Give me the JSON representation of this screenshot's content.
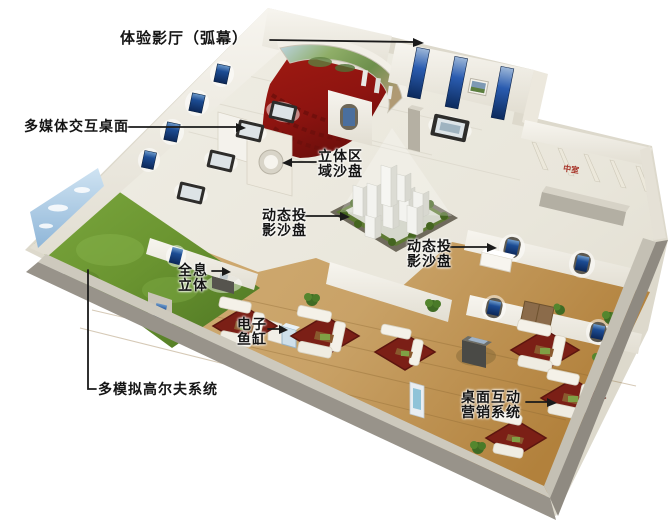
{
  "figure": {
    "type": "exhibition-hall-3d-floorplan",
    "background": "#ffffff"
  },
  "labels": {
    "experience_theater": {
      "text": "体验影厅（弧幕）"
    },
    "multimedia_desk": {
      "text": "多媒体交互桌面"
    },
    "stereo_sandbox": {
      "line1": "立体区",
      "line2": "域沙盘"
    },
    "dynamic_sandbox_left": {
      "line1": "动态投",
      "line2": "影沙盘"
    },
    "dynamic_sandbox_right": {
      "line1": "动态投",
      "line2": "影沙盘"
    },
    "holographic": {
      "line1": "全息",
      "line2": "立体"
    },
    "electronic_fish_tank": {
      "line1": "电子",
      "line2": "鱼缸"
    },
    "golf_simulator": {
      "text": "多模拟高尔夫系统"
    },
    "desktop_marketing": {
      "line1": "桌面互动",
      "line2": "营销系统"
    },
    "room_sign": {
      "text": "中室"
    }
  },
  "colors": {
    "floor_ivory": "#e9e6db",
    "wood_floor": "#c9a76a",
    "grass_green": "#6e9934",
    "cinema_carpet_red": "#8e1410",
    "lounge_carpet_red": "#7b1f16",
    "screen_blue": "#1c4c94",
    "wall_white": "#f3f1ea",
    "outer_wall_gray": "#98938a",
    "label_text": "#151515",
    "sign_red": "#a8352a"
  }
}
